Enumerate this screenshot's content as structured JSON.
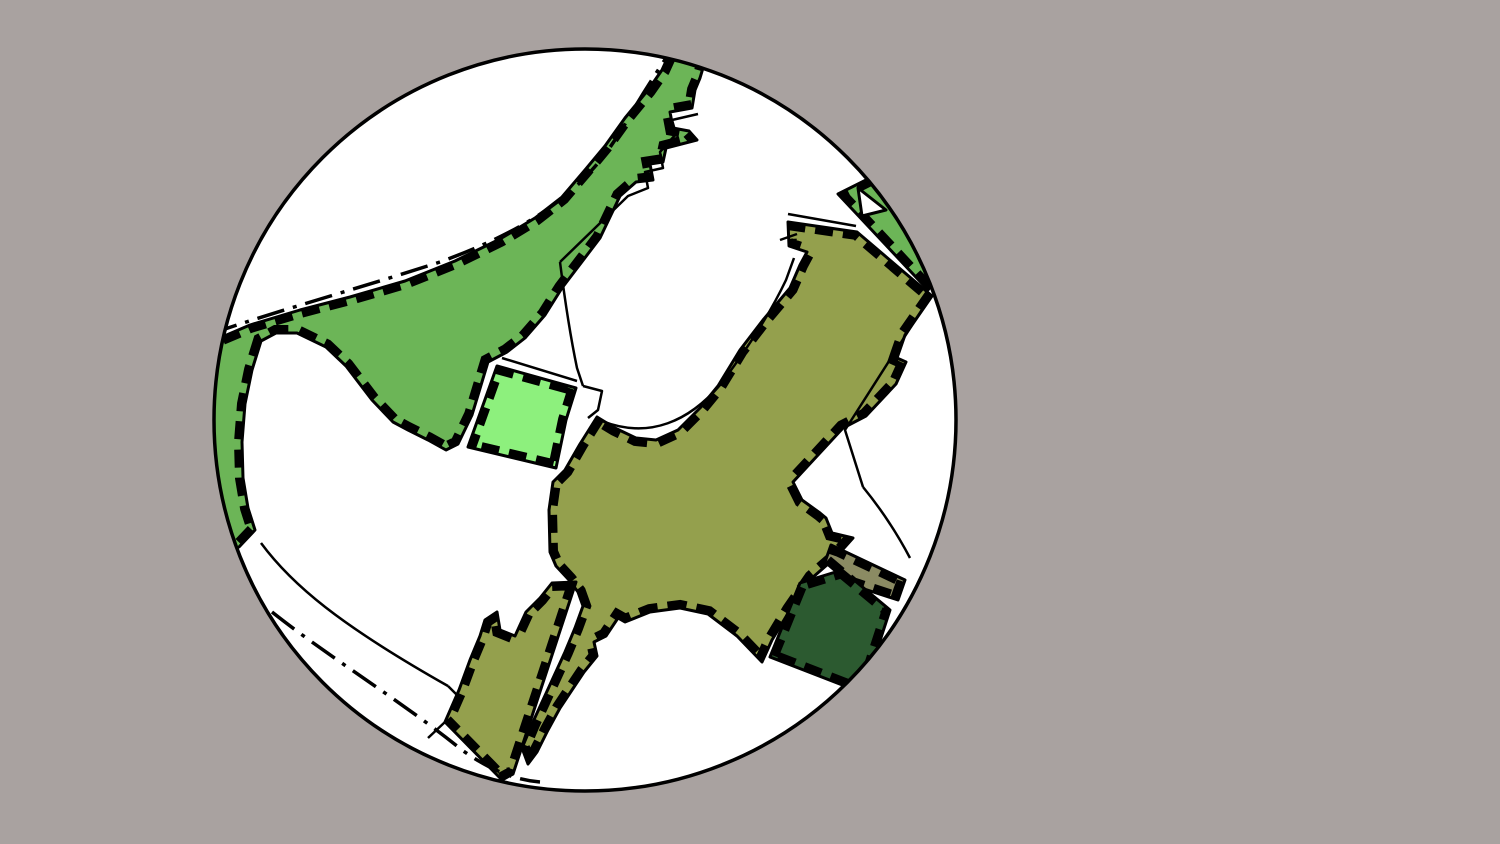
{
  "canvas": {
    "width": 1500,
    "height": 844,
    "background_color": "#a9a2a0"
  },
  "viewport_circle": {
    "cx": 585,
    "cy": 420,
    "r": 371,
    "fill": "#ffffff",
    "stroke": "#000000",
    "stroke_width": 3.5
  },
  "styles": {
    "line_color": "#000000",
    "parcel_outline_width": 3,
    "parcel_dash_stroke_width": 16,
    "parcel_dash_array": "18 10",
    "thin_line_width": 2.5,
    "dashdot_width": 3.5,
    "dashdot_array": "28 9 4 9"
  },
  "palette": {
    "medium_green": "#6cb557",
    "light_green": "#8df07d",
    "olive_green": "#94a04d",
    "gray_olive": "#8b8b63",
    "dark_green": "#2c5a30",
    "white": "#ffffff",
    "background_gray": "#a9a2a0",
    "black": "#000000"
  },
  "parcels": [
    {
      "id": "parcel-green-band",
      "label": "large medium-green band upper-left with strip to top",
      "fill": "#6cb557",
      "dashed": true,
      "points": "196,348 250,325 300,310 350,297 405,281 455,261 500,239 535,218 562,197 585,170 605,146 625,118 648,90 662,70 672,48 706,58 700,78 695,90 692,108 670,112 673,128 689,131 697,140 666,148 663,162 650,164 653,180 636,182 620,196 600,238 562,288 545,315 525,338 507,352 488,362 472,415 458,444 446,450 428,440 408,430 393,422 372,400 346,366 326,347 297,333 276,333 261,341 252,370 245,404 242,442 243,478 248,508 255,530 239,547 196,560"
    },
    {
      "id": "parcel-light-green-field",
      "label": "light green field center-left",
      "fill": "#8df07d",
      "dashed": true,
      "points": "497,366 576,388 566,420 556,468 468,447"
    },
    {
      "id": "parcel-green-triangle",
      "label": "medium green triangle top-right at circle edge",
      "fill": "#6cb557",
      "dashed": true,
      "points": "838,194 928,290 958,250 890,168"
    },
    {
      "id": "parcel-olive-main",
      "label": "large olive-green cross-shaped parcel center",
      "fill": "#94a04d",
      "dashed": true,
      "points": "788,222 857,232 932,296 905,335 897,358 906,362 896,384 866,416 843,428 793,482 802,500 820,513 826,518 832,533 853,538 836,557 812,578 790,610 772,640 762,662 737,636 708,614 680,608 650,612 625,622 618,618 606,636 594,642 597,656 584,672 572,690 560,708 548,730 537,752 528,764 522,748 532,724 543,700 554,676 565,652 575,628 583,606 578,592 569,580 556,566 550,552 549,510 553,482 565,470 580,444 597,417 615,428 636,438 656,440 678,430 700,408 718,386 740,350 763,320 790,288 800,265 807,252 789,246"
    },
    {
      "id": "parcel-olive-arm",
      "label": "olive-green strip parcel lower-left of center",
      "fill": "#94a04d",
      "dashed": true,
      "points": "485,620 497,612 500,630 515,636 526,612 540,598 552,583 576,582 513,774 502,780 445,722 459,690 470,660 480,636"
    },
    {
      "id": "parcel-gray-olive-field",
      "label": "small gray-olive parcel lower-right",
      "fill": "#8b8b63",
      "dashed": true,
      "points": "831,545 905,580 898,600 852,585 825,562"
    },
    {
      "id": "parcel-dark-green-field",
      "label": "dark green parcel lower-right",
      "fill": "#2c5a30",
      "dashed": true,
      "points": "842,570 890,610 863,693 770,657 800,583"
    },
    {
      "id": "white-notch-triangle",
      "label": "white notch in green triangle near circle edge",
      "fill": "#ffffff",
      "dashed": false,
      "points": "858,188 886,210 862,216"
    }
  ],
  "lines": [
    {
      "id": "boundary-dashdot-northwest",
      "kind": "dashdot",
      "path": "M210,334 C280,310 360,288 440,262 C500,240 540,218 572,190 C598,167 615,142 632,112 C645,90 655,75 666,58"
    },
    {
      "id": "boundary-dashdot-southwest",
      "kind": "dashdot",
      "path": "M272,612 C330,658 400,700 462,750 C490,770 515,780 540,782"
    },
    {
      "id": "white-blob-bottom-line",
      "kind": "thin",
      "path": "M261,543 C292,585 340,625 448,686"
    },
    {
      "id": "white-blob-bottom-link",
      "kind": "thin",
      "path": "M448,686 L462,700"
    },
    {
      "id": "arm-corner-line",
      "kind": "thin",
      "path": "M445,722 L428,738"
    },
    {
      "id": "white-parcel-west-line",
      "kind": "thin",
      "path": "M698,114 L672,120 L676,134 L660,152 L663,168 L645,172 L648,188 L628,196 L560,262"
    },
    {
      "id": "white-parcel-southwest-line",
      "kind": "thin",
      "path": "M560,262 Q568,325 577,368 L583,386"
    },
    {
      "id": "road-notch-outline",
      "kind": "thin",
      "path": "M583,386 L602,391 L598,410 L588,418"
    },
    {
      "id": "light-green-road-line",
      "kind": "thin",
      "path": "M502,358 L577,381"
    },
    {
      "id": "white-parcel-south-line",
      "kind": "thin",
      "path": "M602,421 C650,440 690,420 720,385 C745,352 768,318 786,280 L794,258"
    },
    {
      "id": "white-parcel-notch-line",
      "kind": "thin",
      "path": "M780,240 L797,234"
    },
    {
      "id": "white-parcel-top-line",
      "kind": "thin",
      "path": "M788,214 L856,226"
    },
    {
      "id": "leaf-west-line",
      "kind": "thin",
      "path": "M923,308 L845,430 L863,487"
    },
    {
      "id": "leaf-south-line",
      "kind": "thin",
      "path": "M863,487 Q890,520 910,558"
    }
  ]
}
